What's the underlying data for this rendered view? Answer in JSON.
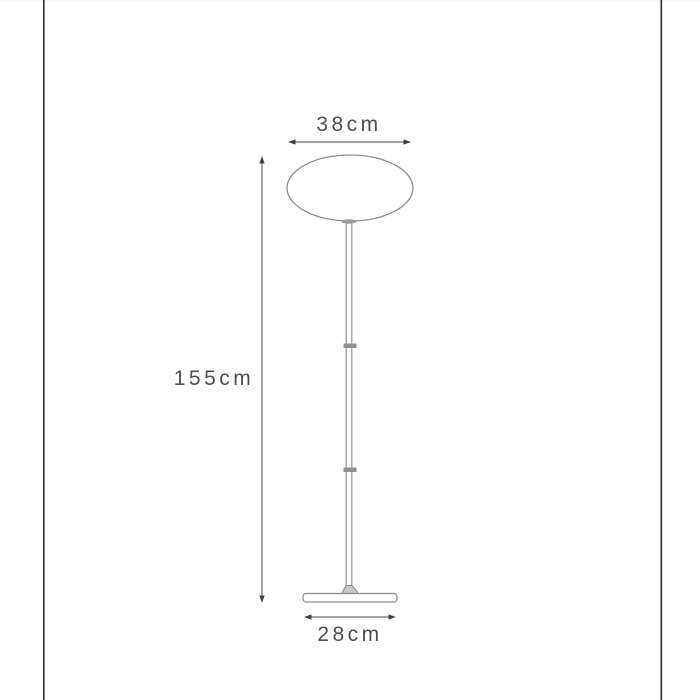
{
  "diagram": {
    "kind": "product-dimension-drawing",
    "product": "floor-lamp",
    "dimensions": {
      "shade_width_label": "38cm",
      "height_label": "155cm",
      "base_width_label": "28cm"
    },
    "colors": {
      "line": "#8c8c8c",
      "dim": "#6a6a6a",
      "arrow": "#3f3f3f",
      "text": "#4f4f4f",
      "frame": "#2e2e2e",
      "joint": "#909090",
      "foot": "#c9c9c9",
      "top_edge": "#f7f7f7"
    }
  }
}
